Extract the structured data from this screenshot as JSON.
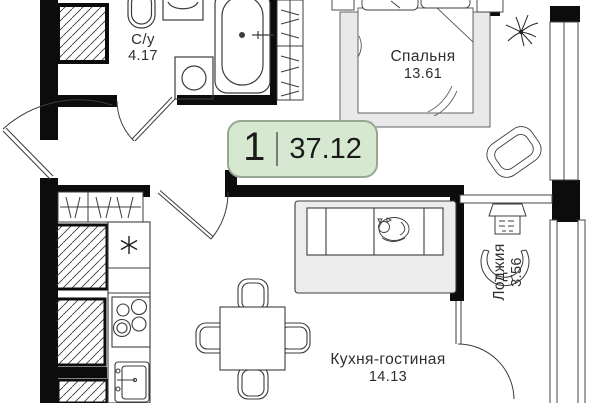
{
  "floor_plan": {
    "badge": {
      "rooms_count": "1",
      "total_area": "37.12"
    },
    "rooms": [
      {
        "name": "С/у",
        "area": "4.17"
      },
      {
        "name": "Спальня",
        "area": "13.61"
      },
      {
        "name": "Кухня-гостиная",
        "area": "14.13"
      },
      {
        "name": "Лоджия",
        "area": "3.56"
      }
    ],
    "icons": {
      "fridge": "snowflake-asterisk",
      "wardrobe": "rod-with-hangers",
      "cabinet": "diagonal-hatch",
      "door": "quarter-circle-swing-arc"
    },
    "colors": {
      "wall": "#0c0c0c",
      "line": "#3c3c3c",
      "furniture_gray": "#e9e9e9",
      "badge_bg": "#d7e8d1",
      "badge_border": "#96a892",
      "text": "#2e2e2e"
    }
  }
}
